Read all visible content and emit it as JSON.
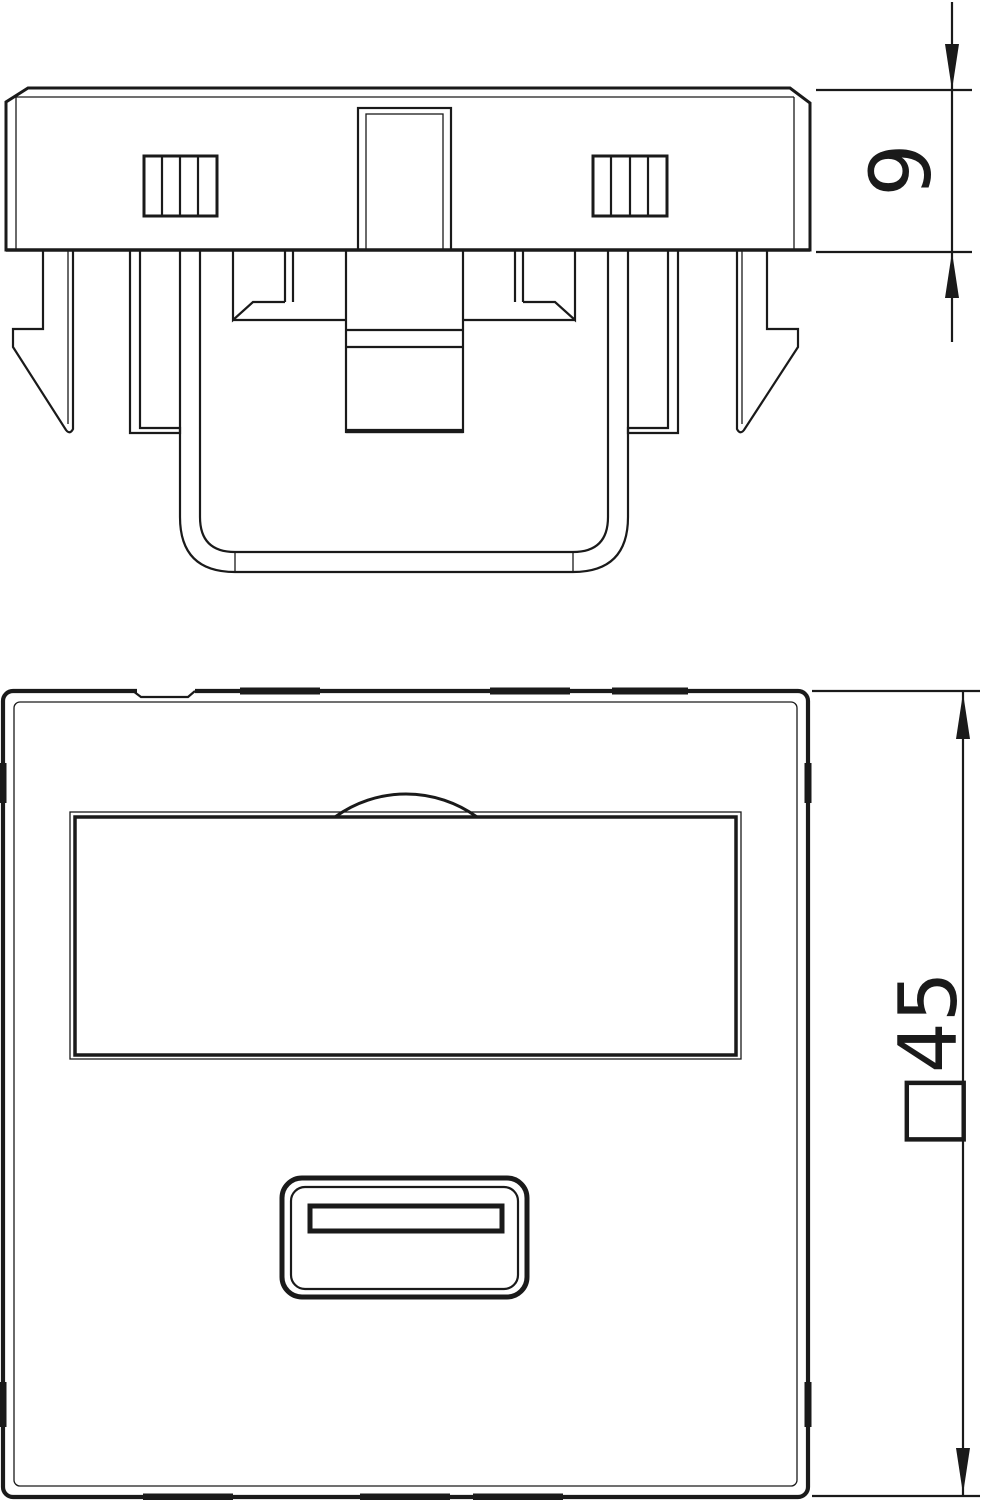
{
  "drawing": {
    "type": "technical-line-drawing",
    "background": "#ffffff",
    "line_color": "#1a1a1a",
    "views": {
      "side_view": {
        "dimension": {
          "label": "9"
        }
      },
      "front_view": {
        "dimension": {
          "label": "□45"
        }
      }
    }
  }
}
